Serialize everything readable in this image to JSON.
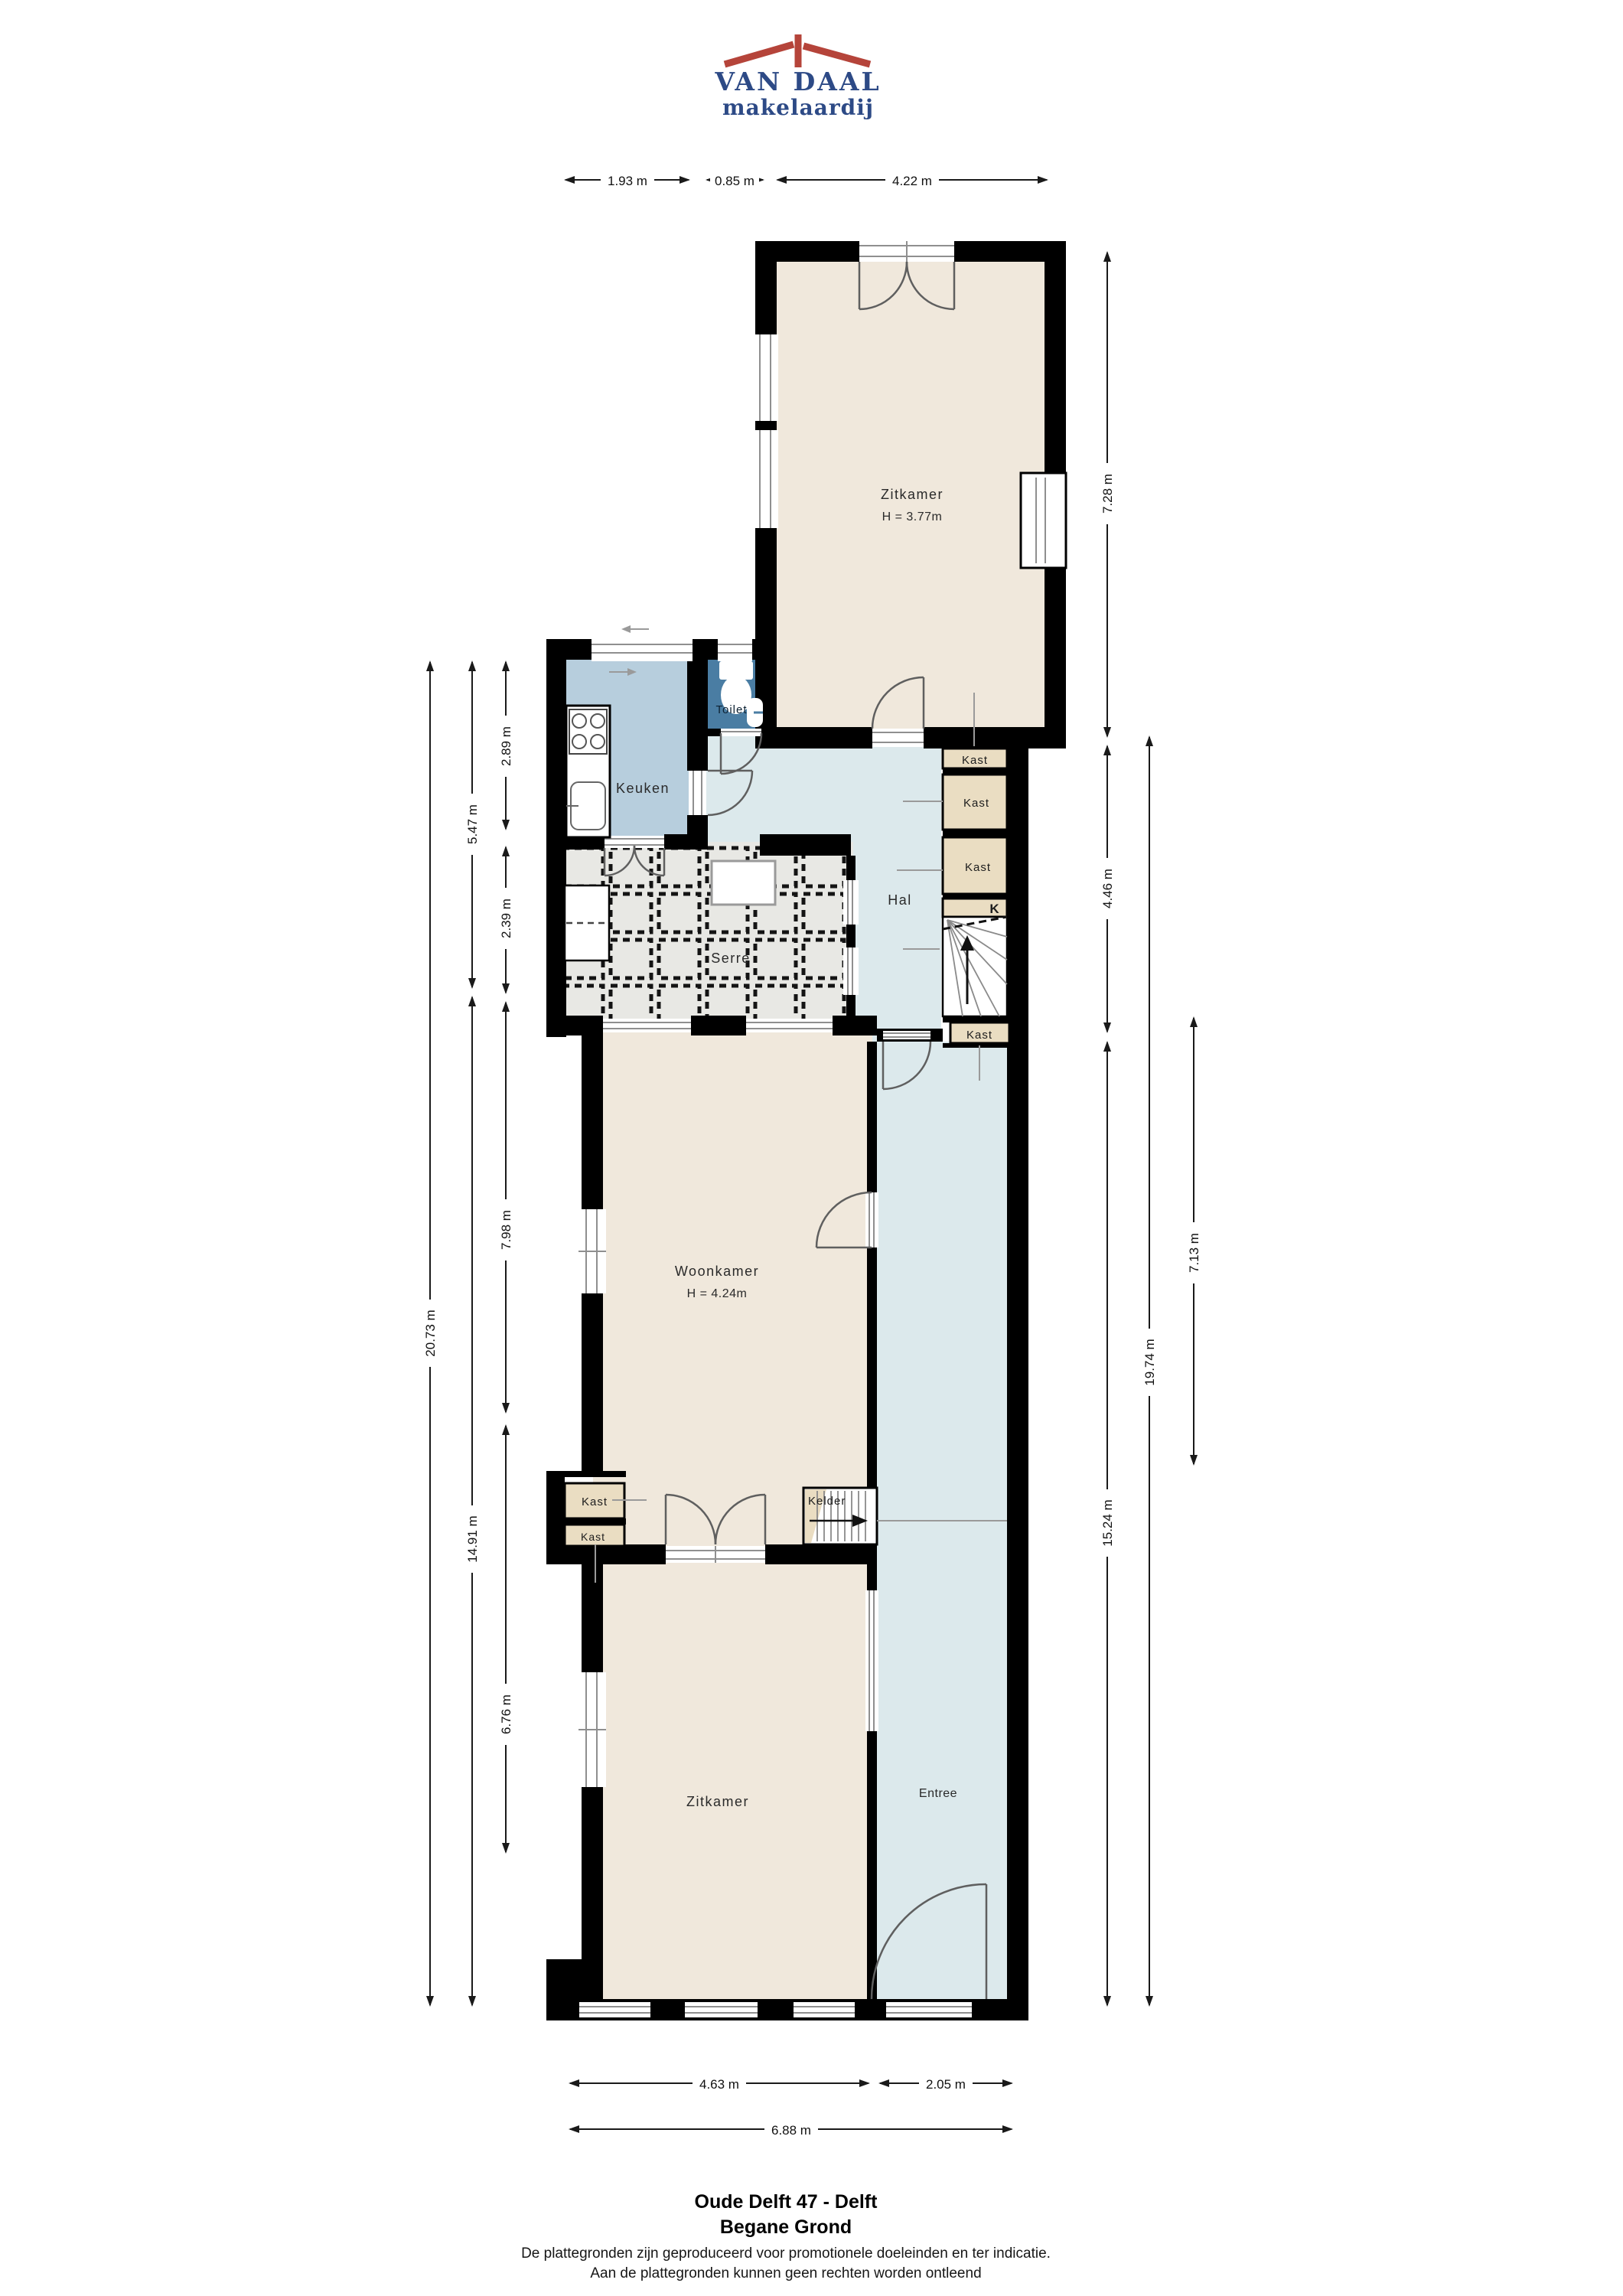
{
  "brand": {
    "name": "VAN DAAL",
    "tagline": "makelaardij"
  },
  "rooms": {
    "zitkamer_top": "Zitkamer",
    "zitkamer_top_height": "H = 3.77m",
    "toilet": "Toilet",
    "keuken": "Keuken",
    "hal": "Hal",
    "serre": "Serre",
    "kast": "Kast",
    "k": "K",
    "kelder": "Kelder",
    "woonkamer": "Woonkamer",
    "woonkamer_height": "H = 4.24m",
    "zitkamer_bottom": "Zitkamer",
    "entree": "Entree"
  },
  "dimensions": {
    "top": [
      "1.93 m",
      "0.85 m",
      "4.22 m"
    ],
    "bottom": [
      "4.63 m",
      "2.05 m",
      "6.88 m"
    ],
    "left": [
      "2.89 m",
      "5.47 m",
      "2.39 m",
      "20.73 m",
      "14.91 m",
      "7.98 m",
      "6.76 m"
    ],
    "right": [
      "7.28 m",
      "4.46 m",
      "7.13 m",
      "19.74 m",
      "15.24 m"
    ]
  },
  "footer": {
    "address": "Oude Delft 47 - Delft",
    "floor": "Begane Grond",
    "disclaimer_line1": "De plattegronden zijn geproduceerd voor promotionele doeleinden en ter indicatie.",
    "disclaimer_line2": "Aan de plattegronden kunnen geen rechten worden ontleend"
  },
  "colors": {
    "wall": "#000000",
    "room_cream": "#f0e8dc",
    "kitchen_blue": "#b7cedd",
    "toilet_blue": "#4a7da3",
    "hall_blue": "#dce9ec",
    "serre_grey": "#e8e8e4",
    "closet_beige": "#eaddc2",
    "logo_blue": "#2d4a86",
    "logo_red": "#b5443a"
  }
}
